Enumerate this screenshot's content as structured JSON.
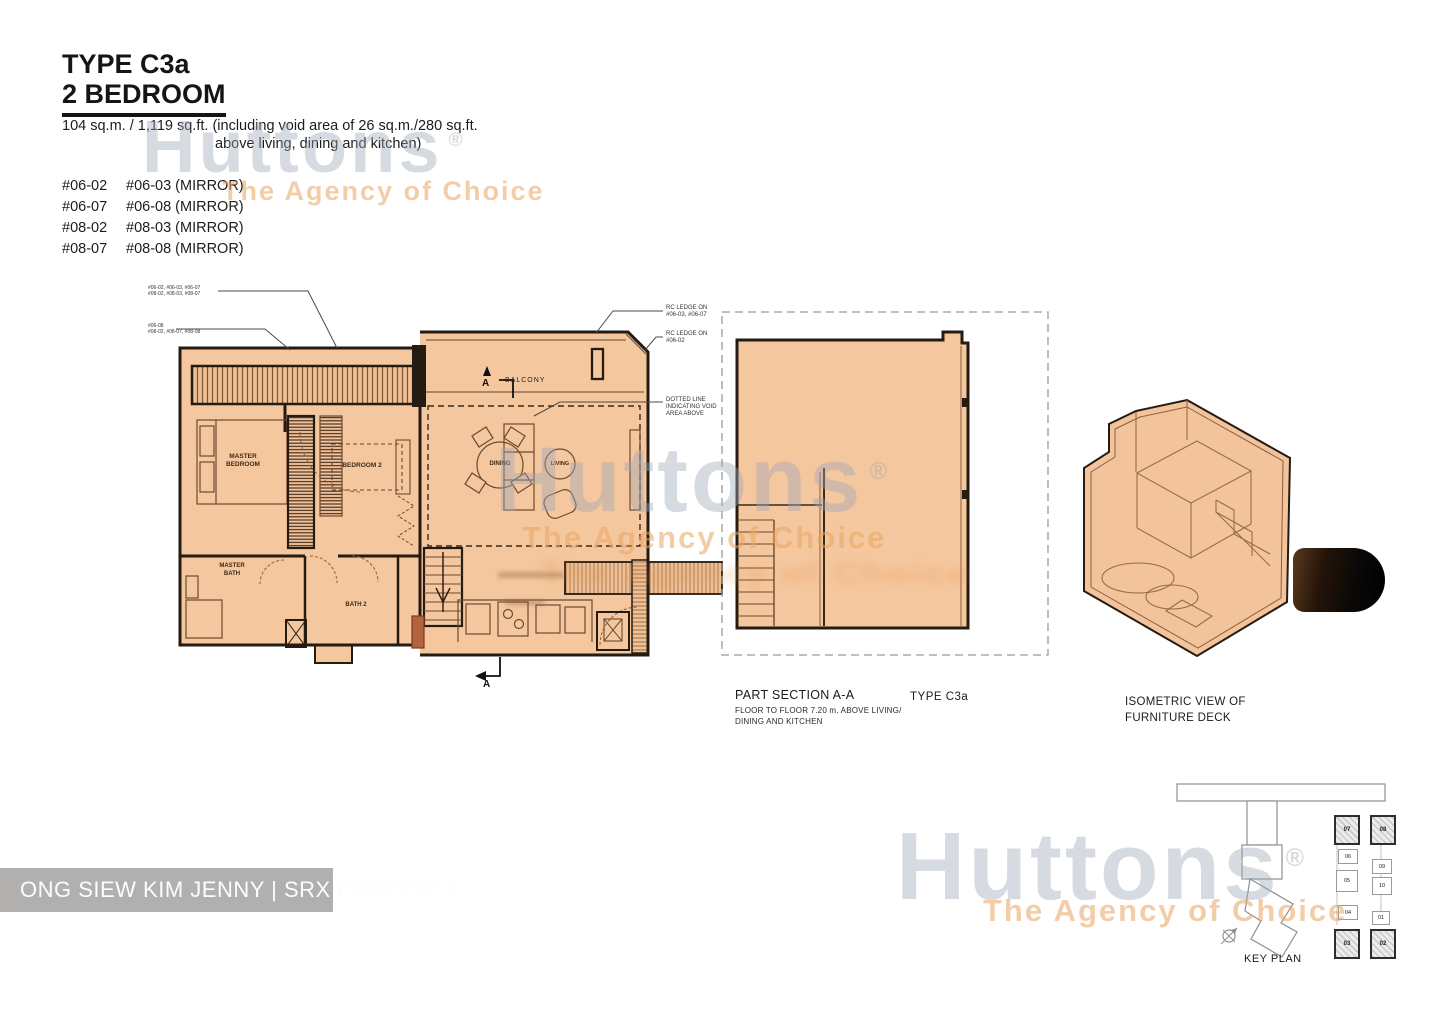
{
  "header": {
    "type_title": "TYPE C3a",
    "bedroom_title": "2 BEDROOM",
    "area_line1": "104 sq.m. / 1,119 sq.ft. (including void area of 26 sq.m./280 sq.ft.",
    "area_line2": "above living, dining and kitchen)",
    "unit_rows": [
      {
        "left": "#06-02",
        "right": "#06-03 (MIRROR)"
      },
      {
        "left": "#06-07",
        "right": "#06-08 (MIRROR)"
      },
      {
        "left": "#08-02",
        "right": "#08-03 (MIRROR)"
      },
      {
        "left": "#08-07",
        "right": "#08-08 (MIRROR)"
      }
    ]
  },
  "watermark": {
    "brand": "Huttons",
    "registered": "®",
    "tagline": "The Agency of Choice"
  },
  "floor_plan": {
    "callout1_line1": "#06-02, #06-03, #06-07",
    "callout1_line2": "#08-02, #08-03, #08-07",
    "callout2_line1": "#06-08",
    "callout2_line2": "#08-02, #08-07, #08-08",
    "rc_note1_line1": "RC LEDGE ON",
    "rc_note1_line2": "#06-03, #06-07",
    "rc_note2_line1": "RC LEDGE ON",
    "rc_note2_line2": "#06-02",
    "void_note_line1": "DOTTED LINE",
    "void_note_line2": "INDICATING VOID",
    "void_note_line3": "AREA ABOVE",
    "balcony_label": "BALCONY",
    "section_marker": "A",
    "rooms": {
      "master_bedroom_l1": "MASTER",
      "master_bedroom_l2": "BEDROOM",
      "bedroom2": "BEDROOM 2",
      "dining": "DINING",
      "living": "LIVING",
      "master_bath_l1": "MASTER",
      "master_bath_l2": "BATH",
      "bath2": "BATH 2"
    }
  },
  "section": {
    "title": "PART SECTION A-A",
    "subtitle_line1": "FLOOR TO FLOOR  7.20 m. ABOVE LIVING/",
    "subtitle_line2": "DINING AND KITCHEN",
    "type_label": "TYPE  C3a"
  },
  "isometric": {
    "caption_line1": "ISOMETRIC VIEW OF",
    "caption_line2": "FURNITURE DECK"
  },
  "key_plan": {
    "label": "KEY PLAN",
    "stack_units": [
      "07",
      "08",
      "06",
      "09",
      "05",
      "10",
      "04",
      "01",
      "03",
      "02"
    ]
  },
  "footer": {
    "agent_text": "ONG SIEW KIM JENNY | SRX PROPERTY"
  },
  "colors": {
    "plan_fill": "#f5c79e",
    "wall": "#241b12",
    "watermark_gray": "#9ea8b8",
    "watermark_orange": "#eaa460",
    "footer_bg": "#b1b0af"
  }
}
